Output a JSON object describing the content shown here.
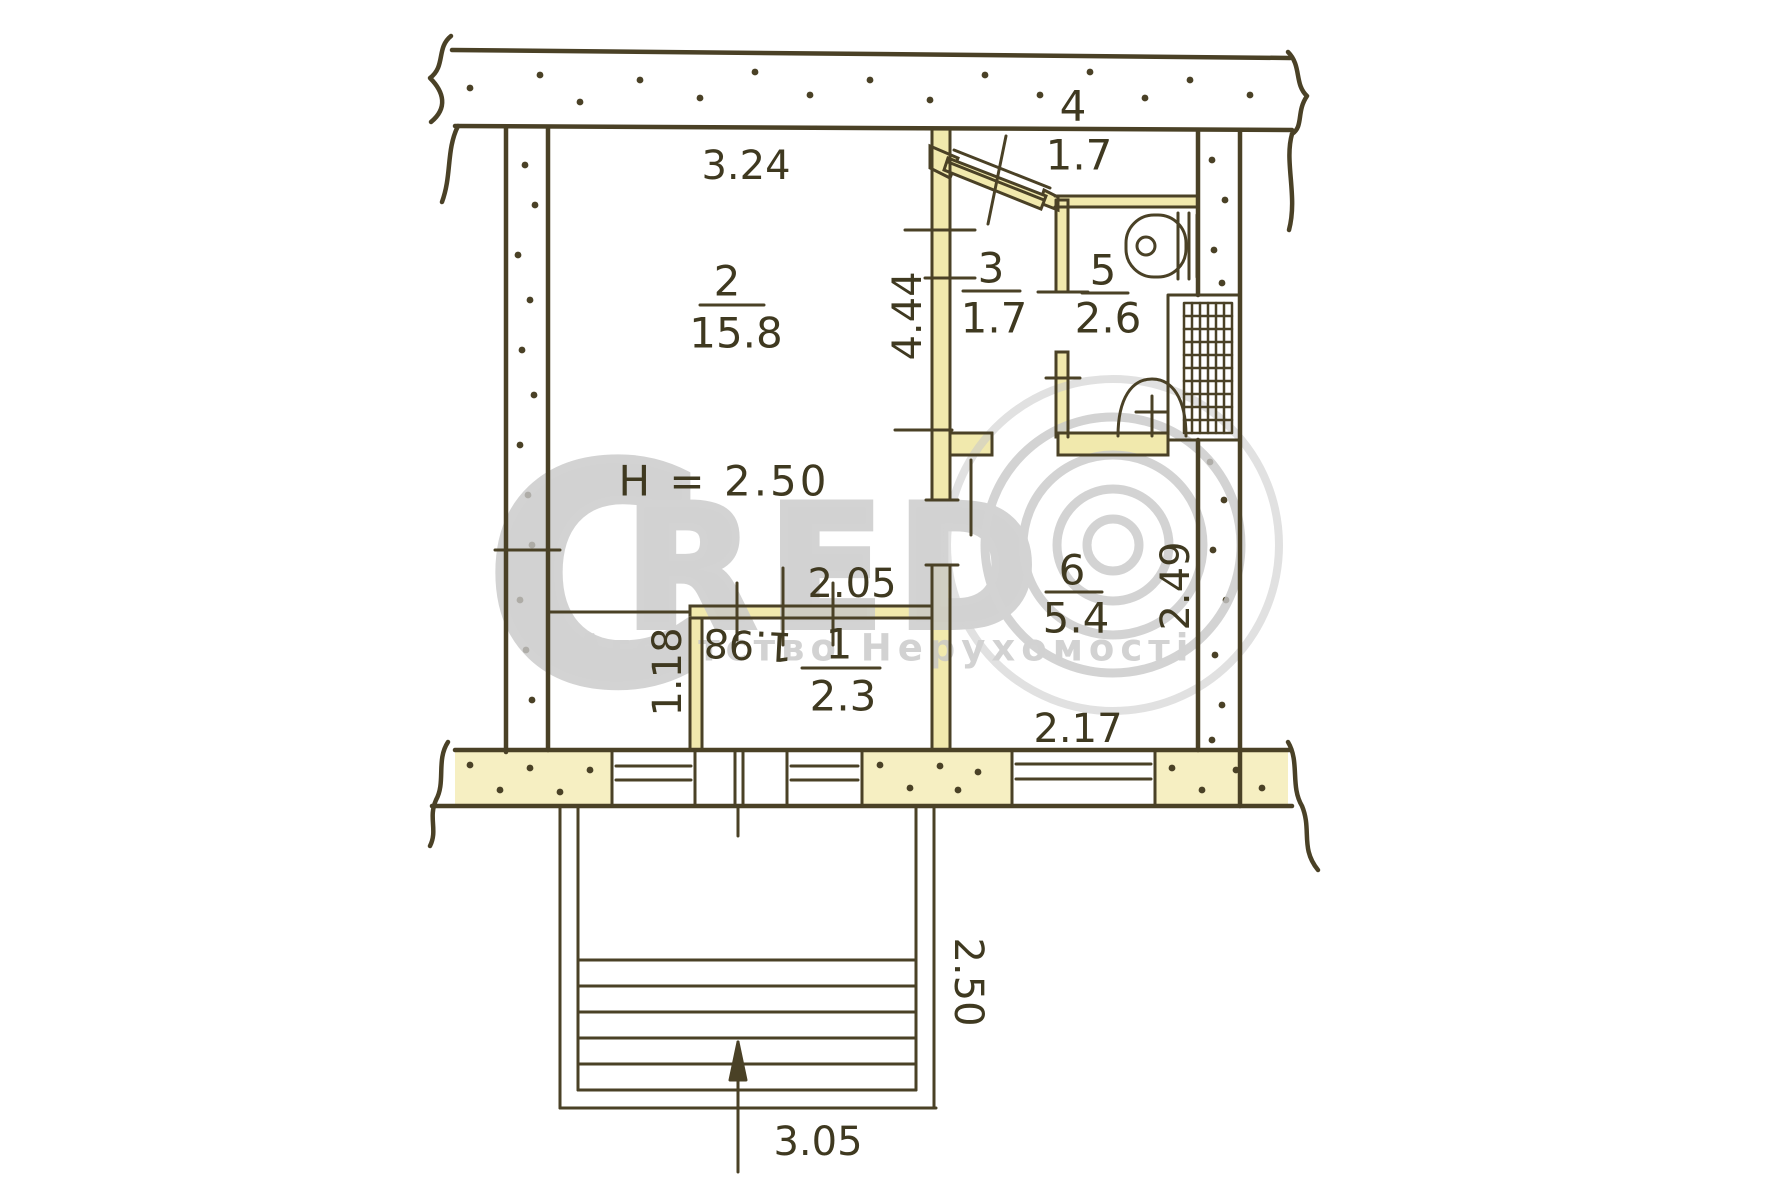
{
  "watermark": {
    "brand_letter_c": "C",
    "brand_letters_red": "RED",
    "agency_line": "Агентство Нерухомості"
  },
  "plan": {
    "ceiling_height_note": "H = 2.50",
    "rooms": {
      "room1": {
        "number": "1",
        "area": "2.3"
      },
      "room2": {
        "number": "2",
        "area": "15.8"
      },
      "room3": {
        "number": "3",
        "area": "1.7"
      },
      "room4": {
        "number": "4",
        "area": "1.7"
      },
      "room5": {
        "number": "5",
        "area": "2.6"
      },
      "room6": {
        "number": "6",
        "area": "5.4"
      }
    },
    "dims": {
      "top_width": "3.24",
      "hall_depth": "4.44",
      "closet_width": "2.05",
      "closet_clear_width": "1.98",
      "closet_offset": "1.18",
      "room6_width": "2.17",
      "room6_depth": "2.49",
      "balcony_depth": "2.50",
      "balcony_width": "3.05"
    },
    "colors": {
      "ink": "#4a4126",
      "wall_fill": "#f1e9ad",
      "watermark_gray": "#c9c9c9",
      "paper": "#ffffff"
    }
  }
}
